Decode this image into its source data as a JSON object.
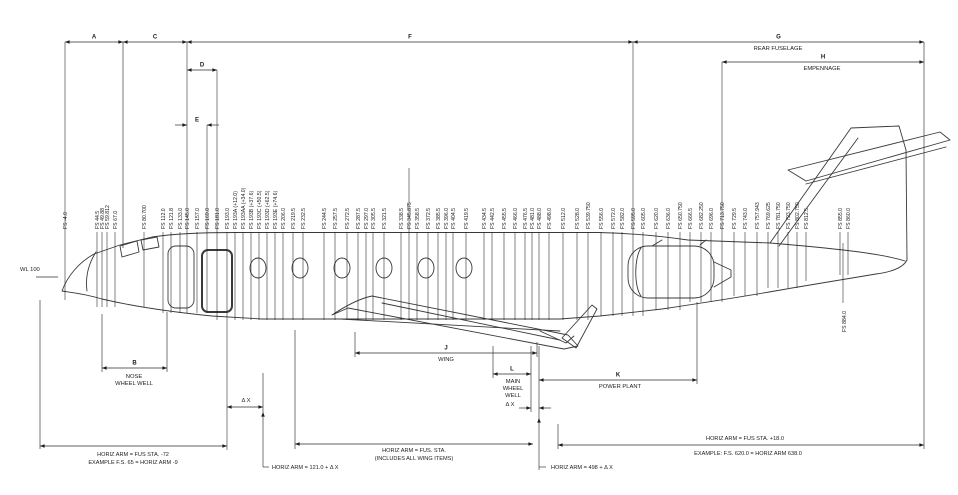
{
  "diagram": {
    "colors": {
      "ink": "#1c1c1c",
      "line": "#2e2e2e",
      "aircraft": "#3a3a3a",
      "background": "#ffffff"
    },
    "waterline_label": "WL 100",
    "stations": [
      {
        "label": "FS -4.0",
        "x": 65,
        "top": 42,
        "bot": 300
      },
      {
        "label": "FS 44.5",
        "x": 97
      },
      {
        "label": "FS 49.88",
        "x": 102
      },
      {
        "label": "FS 59.812",
        "x": 107
      },
      {
        "label": "FS 67.0",
        "x": 115
      },
      {
        "label": "FS 80.700",
        "x": 144
      },
      {
        "label": "FS 112.0",
        "x": 163
      },
      {
        "label": "FS 121.8",
        "x": 171
      },
      {
        "label": "FS 133.0",
        "x": 180
      },
      {
        "label": "FS 145.0",
        "x": 187,
        "top": 42
      },
      {
        "label": "FS 157.0",
        "x": 197
      },
      {
        "label": "FS 169.0",
        "x": 207,
        "top": 125
      },
      {
        "label": "FS 181.0",
        "x": 217,
        "top": 70
      },
      {
        "label": "FS 193.0",
        "x": 227,
        "bot": 450
      },
      {
        "label": "FS 193A (+12.0)",
        "x": 235
      },
      {
        "label": "FS 193AA (+34.0)",
        "x": 243
      },
      {
        "label": "FS 193B (+37.6)",
        "x": 251
      },
      {
        "label": "FS 193C (+50.5)",
        "x": 259
      },
      {
        "label": "FS 193D (+62.5)",
        "x": 267
      },
      {
        "label": "FS 193E (+74.6)",
        "x": 275
      },
      {
        "label": "FS 206.0",
        "x": 283
      },
      {
        "label": "FS 219.5",
        "x": 293
      },
      {
        "label": "FS 232.5",
        "x": 303
      },
      {
        "label": "FS 244.5",
        "x": 324
      },
      {
        "label": "FS 257.5",
        "x": 335
      },
      {
        "label": "FS 272.5",
        "x": 347
      },
      {
        "label": "FS 287.5",
        "x": 358
      },
      {
        "label": "FS 297.0",
        "x": 366
      },
      {
        "label": "FS 305.5",
        "x": 373
      },
      {
        "label": "FS 321.5",
        "x": 384
      },
      {
        "label": "FS 338.5",
        "x": 401
      },
      {
        "label": "FS 345.875",
        "x": 409,
        "top": 168
      },
      {
        "label": "FS 358.5",
        "x": 417
      },
      {
        "label": "FS 372.5",
        "x": 428
      },
      {
        "label": "FS 385.5",
        "x": 438
      },
      {
        "label": "FS 396.0",
        "x": 446
      },
      {
        "label": "FS 404.5",
        "x": 453
      },
      {
        "label": "FS 419.5",
        "x": 466
      },
      {
        "label": "FS 434.5",
        "x": 484
      },
      {
        "label": "FS 442.5",
        "x": 492
      },
      {
        "label": "FS 455.5",
        "x": 504
      },
      {
        "label": "FS 466.0",
        "x": 515
      },
      {
        "label": "FS 476.5",
        "x": 525
      },
      {
        "label": "FS 481.0",
        "x": 532
      },
      {
        "label": "FS 488.0",
        "x": 539
      },
      {
        "label": "FS 498.0",
        "x": 549
      },
      {
        "label": "FS 512.0",
        "x": 563
      },
      {
        "label": "FS 528.0",
        "x": 577
      },
      {
        "label": "FS 539.750",
        "x": 588
      },
      {
        "label": "FS 556.0",
        "x": 601
      },
      {
        "label": "FS 572.0",
        "x": 613
      },
      {
        "label": "FS 582.0",
        "x": 622
      },
      {
        "label": "FS 595.0",
        "x": 633,
        "top": 42
      },
      {
        "label": "FS 605.0",
        "x": 643
      },
      {
        "label": "FS 620.0",
        "x": 656
      },
      {
        "label": "FS 636.0",
        "x": 668
      },
      {
        "label": "FS 650.750",
        "x": 680
      },
      {
        "label": "FS 666.5",
        "x": 690
      },
      {
        "label": "FS 682.250",
        "x": 701
      },
      {
        "label": "FS 696.0",
        "x": 711
      },
      {
        "label": "FS 713.750",
        "x": 722,
        "top": 62
      },
      {
        "label": "FS 729.5",
        "x": 734
      },
      {
        "label": "FS 743.0",
        "x": 745
      },
      {
        "label": "FS 757.943",
        "x": 757
      },
      {
        "label": "FS 769.625",
        "x": 768
      },
      {
        "label": "FS 781.750",
        "x": 778
      },
      {
        "label": "FS 793.750",
        "x": 788
      },
      {
        "label": "FS 802.750",
        "x": 797
      },
      {
        "label": "FS 812.5",
        "x": 806
      },
      {
        "label": "FS 855.0",
        "x": 840
      },
      {
        "label": "FS 860.0",
        "x": 848
      }
    ],
    "tail_station": {
      "label": "FS 884.0",
      "x": 843,
      "line_top": 243,
      "line_bot": 303,
      "text_y": 332
    },
    "dims": [
      {
        "label": "A",
        "x1": 65,
        "x2": 123,
        "y": 42
      },
      {
        "label": "C",
        "x1": 123,
        "x2": 187,
        "y": 42
      },
      {
        "label": "F",
        "x1": 187,
        "x2": 633,
        "y": 42
      },
      {
        "label": "G",
        "x1": 633,
        "x2": 924,
        "y": 42
      },
      {
        "label": "H",
        "x1": 722,
        "x2": 924,
        "y": 62
      },
      {
        "label": "D",
        "x1": 187,
        "x2": 217,
        "y": 70
      },
      {
        "label": "E",
        "x1": 187,
        "x2": 207,
        "y": 125,
        "outside": true
      },
      {
        "label": "B",
        "x1": 102,
        "x2": 167,
        "y": 368
      },
      {
        "label": "J",
        "x1": 355,
        "x2": 537,
        "y": 353
      },
      {
        "label": "L",
        "x1": 493,
        "x2": 531,
        "y": 374
      },
      {
        "label": "K",
        "x1": 539,
        "x2": 697,
        "y": 380
      },
      {
        "label": "",
        "x1": 227,
        "x2": 263,
        "y": 407
      },
      {
        "label": "",
        "x1": 531,
        "x2": 539,
        "y": 408,
        "outside": true
      },
      {
        "label": "",
        "x1": 40,
        "x2": 227,
        "y": 446
      },
      {
        "label": "",
        "x1": 295,
        "x2": 533,
        "y": 444
      },
      {
        "label": "",
        "x1": 558,
        "x2": 924,
        "y": 445
      }
    ],
    "guides": [
      {
        "x": 123,
        "y1": 42,
        "y2": 248
      },
      {
        "x": 40,
        "y1": 300,
        "y2": 449
      },
      {
        "x": 102,
        "y1": 314,
        "y2": 372
      },
      {
        "x": 167,
        "y1": 312,
        "y2": 372
      },
      {
        "x": 263,
        "y1": 373,
        "y2": 467
      },
      {
        "x": 295,
        "y1": 330,
        "y2": 449
      },
      {
        "x": 355,
        "y1": 332,
        "y2": 357
      },
      {
        "x": 493,
        "y1": 346,
        "y2": 378
      },
      {
        "x": 531,
        "y1": 346,
        "y2": 412
      },
      {
        "x": 537,
        "y1": 342,
        "y2": 357
      },
      {
        "x": 539,
        "y1": 346,
        "y2": 470
      },
      {
        "x": 558,
        "y1": 424,
        "y2": 449
      },
      {
        "x": 697,
        "y1": 302,
        "y2": 384
      },
      {
        "x": 924,
        "y1": 42,
        "y2": 449
      }
    ],
    "elbows": [
      {
        "tick": [
          263,
          467,
          269,
          467
        ],
        "arrow_up": [
          263,
          412
        ]
      },
      {
        "tick": [
          539,
          467,
          546,
          467
        ],
        "arrow_up": [
          539,
          418
        ]
      }
    ],
    "texts": [
      {
        "name": "waterline-label",
        "text": "WL 100",
        "x": 20,
        "y": 271,
        "anchor": "start",
        "size": 5.8
      },
      {
        "name": "rear-fuselage-caption",
        "text": "REAR FUSELAGE",
        "x": 778,
        "y": 50,
        "anchor": "middle",
        "size": 5.8
      },
      {
        "name": "empennage-caption",
        "text": "EMPENNAGE",
        "x": 822,
        "y": 70,
        "anchor": "middle",
        "size": 5.8
      },
      {
        "name": "nose-wheel-well-caption-1",
        "text": "NOSE",
        "x": 134,
        "y": 378,
        "anchor": "middle",
        "size": 5.8
      },
      {
        "name": "nose-wheel-well-caption-2",
        "text": "WHEEL WELL",
        "x": 134,
        "y": 385,
        "anchor": "middle",
        "size": 5.8
      },
      {
        "name": "wing-caption",
        "text": "WING",
        "x": 446,
        "y": 361,
        "anchor": "middle",
        "size": 5.8
      },
      {
        "name": "main-wheel-well-caption-1",
        "text": "MAIN",
        "x": 513,
        "y": 383,
        "anchor": "middle",
        "size": 5.8
      },
      {
        "name": "main-wheel-well-caption-2",
        "text": "WHEEL",
        "x": 513,
        "y": 390,
        "anchor": "middle",
        "size": 5.8
      },
      {
        "name": "main-wheel-well-caption-3",
        "text": "WELL",
        "x": 513,
        "y": 397,
        "anchor": "middle",
        "size": 5.8
      },
      {
        "name": "power-plant-caption",
        "text": "POWER PLANT",
        "x": 620,
        "y": 388,
        "anchor": "middle",
        "size": 5.8
      },
      {
        "name": "delta-x-left-label",
        "text": "Δ X",
        "x": 246,
        "y": 402,
        "anchor": "middle",
        "size": 5.8
      },
      {
        "name": "delta-x-right-label",
        "text": "Δ X",
        "x": 510,
        "y": 406,
        "anchor": "middle",
        "size": 5.8
      },
      {
        "name": "horiz-arm-left-note-1",
        "text": "HORIZ ARM = FUS STA. -72",
        "x": 133,
        "y": 456,
        "anchor": "middle",
        "size": 5.6
      },
      {
        "name": "horiz-arm-left-note-2",
        "text": "EXAMPLE F.S. 65 = HORIZ ARM -9",
        "x": 133,
        "y": 464,
        "anchor": "middle",
        "size": 5.6
      },
      {
        "name": "horiz-arm-mid-note-1",
        "text": "HORIZ ARM = FUS. STA.",
        "x": 414,
        "y": 452,
        "anchor": "middle",
        "size": 5.6
      },
      {
        "name": "horiz-arm-mid-note-2",
        "text": "(INCLUDES ALL WING ITEMS)",
        "x": 414,
        "y": 460,
        "anchor": "middle",
        "size": 5.6
      },
      {
        "name": "horiz-arm-right-note-1",
        "text": "HORIZ ARM = FUS STA. +18.0",
        "x": 745,
        "y": 440,
        "anchor": "middle",
        "size": 5.6
      },
      {
        "name": "horiz-arm-right-note-2",
        "text": "EXAMPLE: F.S. 620.0 = HORIZ ARM 638.0",
        "x": 748,
        "y": 455,
        "anchor": "middle",
        "size": 5.6
      },
      {
        "name": "horiz-arm-121-note",
        "text": "HORIZ ARM = 121.0 + Δ X",
        "x": 272,
        "y": 469,
        "anchor": "start",
        "size": 5.6
      },
      {
        "name": "horiz-arm-498-note",
        "text": "HORIZ ARM = 498 + Δ X",
        "x": 551,
        "y": 469,
        "anchor": "start",
        "size": 5.6
      }
    ]
  }
}
